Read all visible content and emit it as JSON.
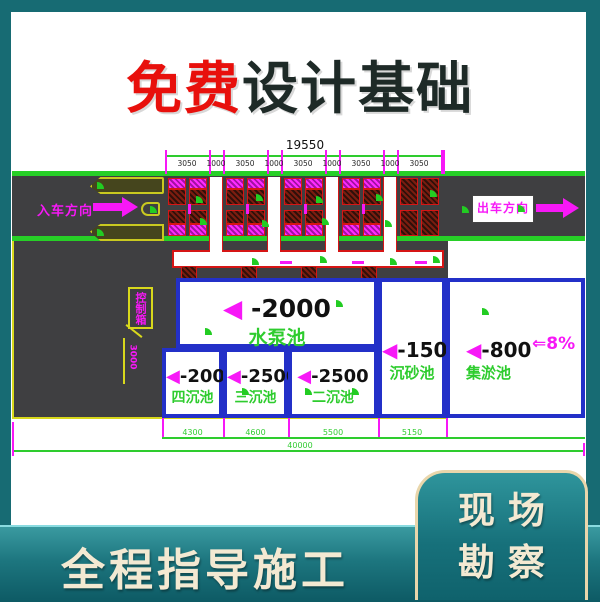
{
  "title": {
    "highlight": "免费",
    "rest": "设计基础",
    "highlight_color": "#e8100c",
    "text_color": "#1e2a27"
  },
  "banner": {
    "text": "全程指导施工"
  },
  "corner_card": {
    "line1": "现 场",
    "line2": "勘 察"
  },
  "diagram": {
    "entrance_label": "入车方向",
    "exit_label": "出车方向",
    "slope_label": "⇐8%",
    "callout_label": "控制箱",
    "vertical_dim": "3000",
    "dimensions": {
      "top_total": "19550",
      "top_segments": [
        "3050",
        "1000",
        "3050",
        "1000",
        "3050",
        "1000",
        "3050",
        "1000",
        "3050"
      ],
      "bottom_segments": [
        "4300",
        "4600",
        "5500",
        "5150"
      ],
      "bottom_total": "40000"
    },
    "pools": [
      {
        "depth": "-2000",
        "name": "水泵池"
      },
      {
        "depth": "-1500",
        "name": "沉砂池"
      },
      {
        "depth": "-800",
        "name": "集淤池"
      },
      {
        "depth": "-2000",
        "name": "四沉池"
      },
      {
        "depth": "-2500",
        "name": "三沉池"
      },
      {
        "depth": "-2500",
        "name": "二沉池"
      }
    ],
    "colors": {
      "road": "#3f3f41",
      "cad_green": "#2ecc2e",
      "magenta": "#f718f7",
      "pool_border": "#2330c8",
      "hatch_red": "#d61515",
      "yellow": "#d8d81c",
      "frame_teal": "#176b73"
    }
  }
}
